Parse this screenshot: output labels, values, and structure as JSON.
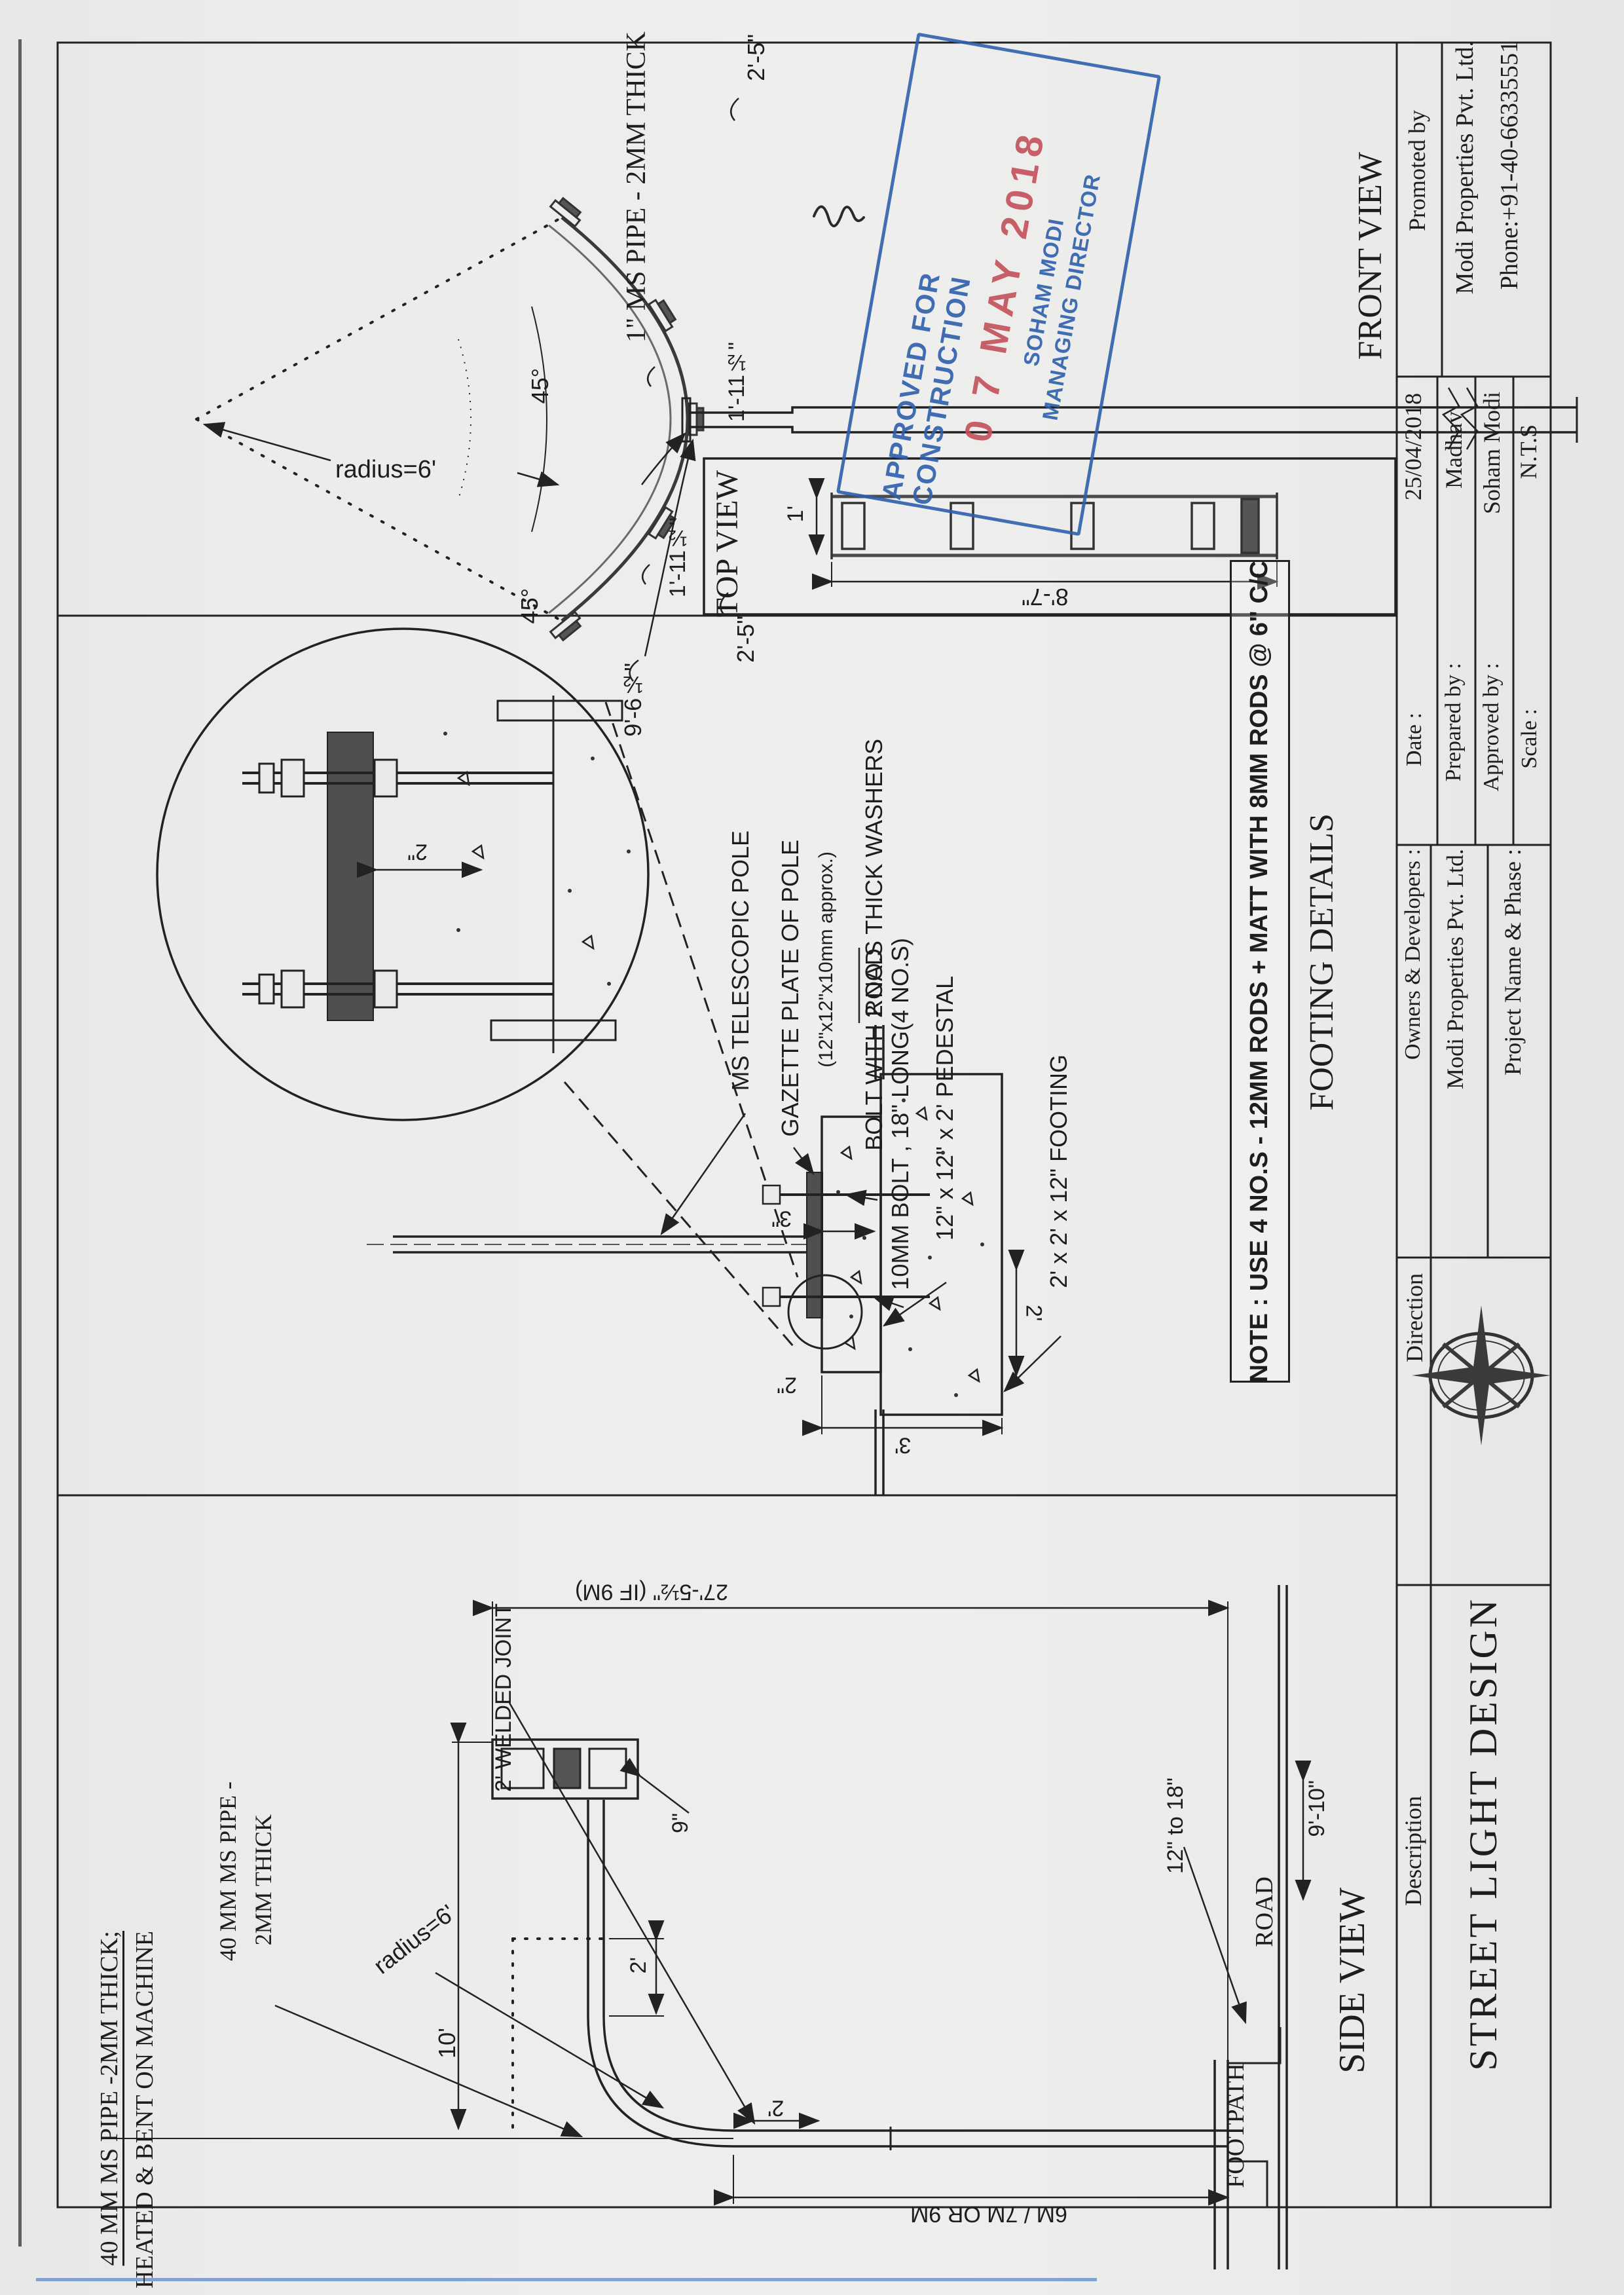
{
  "stamp": {
    "line1": "APPROVED FOR CONSTRUCTION",
    "date": "0 7 MAY 2018",
    "name": "SOHAM MODI",
    "role": "MANAGING DIRECTOR",
    "border_color": "#2d5fae",
    "date_color": "#c4505a"
  },
  "front_view": {
    "title": "FRONT VIEW",
    "pipe_label": "1\" MS PIPE - 2MM THICK",
    "radius_label": "radius=6'",
    "angle_upper": "45°",
    "angle_lower": "45°",
    "dim_end_upper": "2'-5\"",
    "dim_end_lower": "2'-5\"",
    "dim_inner_upper": "1'-11½\"",
    "dim_inner_lower": "1'-11½\"",
    "dim_arc": "9'-6½\""
  },
  "top_view": {
    "title": "TOP VIEW",
    "dim_width": "1'",
    "dim_length": "8'-7\""
  },
  "footing_details": {
    "title": "FOOTING DETAILS",
    "labels": {
      "pole": "MS TELESCOPIC POLE",
      "plate": "GAZETTE PLATE OF POLE",
      "plate_size": "(12\"x12\"x10mm approx.)",
      "washers": "BOLT WITH 2 NO.S THICK WASHERS",
      "road": "ROAD",
      "bolt": "10MM BOLT , 18\" LONG(4 NO.S)",
      "pedestal": "12\" x 12\" x 2' PEDESTAL",
      "footing": "2' x 2' x 12\" FOOTING"
    },
    "dims": {
      "plate_gap": "2\"",
      "top_offset": "3\"",
      "side_gap": "2\"",
      "depth": "2'",
      "width": "3'"
    },
    "note": "NOTE : USE 4 NO.S - 12MM RODS + MATT WITH 8MM RODS @ 6\" C/C"
  },
  "side_view": {
    "title": "SIDE VIEW",
    "pipe_note_1": "40 MM MS PIPE -2MM THICK;",
    "pipe_note_2": "HEATED & BENT ON MACHINE",
    "pipe_label_1": "40 MM MS PIPE -",
    "pipe_label_2": "2MM THICK",
    "radius_label": "radius=6'",
    "welded_joint": "2' WELDED JOINT",
    "dim_arm": "10'",
    "dim_drop": "2'",
    "dim_head": "9\"",
    "dim_weld": "2'",
    "dim_total": "27'-5½\" (IF 9M)",
    "dim_pole": "6M / 7M OR 9M",
    "dim_kerb": "12\" to 18\"",
    "dim_clear": "9'-10\"",
    "footpath": "FOOTPATH",
    "road": "ROAD"
  },
  "title_block": {
    "promoted_label": "Promoted by",
    "promoted_company": "Modi Properties Pvt. Ltd.",
    "promoted_phone": "Phone:+91-40-66335551",
    "date_label": "Date :",
    "date_value": "25/04/2018",
    "prepared_label": "Prepared by :",
    "prepared_value": "Madhav",
    "approved_label": "Approved by :",
    "approved_value": "Soham Modi",
    "scale_label": "Scale :",
    "scale_value": "N.T.S",
    "owners_label": "Owners & Developers :",
    "owners_company": "Modi Properties Pvt. Ltd.",
    "owners_project": "Project Name & Phase :",
    "direction_label": "Direction",
    "description_label": "Description",
    "description_value": "STREET LIGHT DESIGN"
  }
}
